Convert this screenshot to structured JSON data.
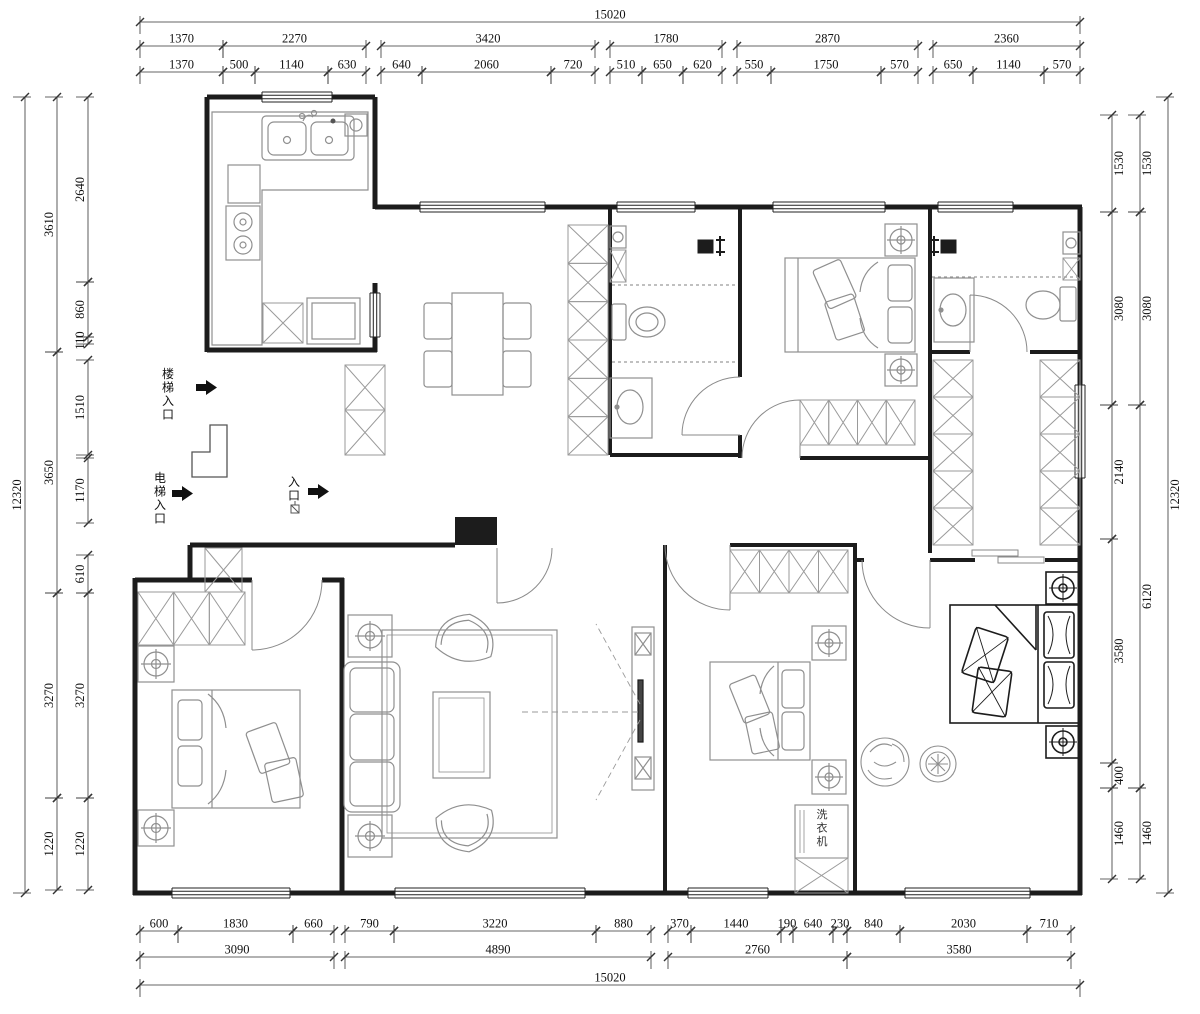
{
  "plan": {
    "unit": "mm",
    "overall_width": "15020",
    "overall_height": "12320"
  },
  "colors": {
    "wall": "#1c1c1c",
    "furniture": "#8f8f8f",
    "dark_furniture": "#1c1c1c",
    "dimension": "#333333",
    "background": "#ffffff"
  },
  "labels": [
    {
      "id": "stair-entrance",
      "text": "楼梯入口",
      "x": 168,
      "y": 366,
      "vertical": true
    },
    {
      "id": "elevator-entrance",
      "text": "电梯入口",
      "x": 160,
      "y": 470,
      "vertical": true
    },
    {
      "id": "entrance",
      "text": "入口",
      "x": 294,
      "y": 474,
      "vertical": true
    },
    {
      "id": "washing-machine",
      "text": "洗衣机",
      "x": 822,
      "y": 806,
      "vertical": true
    }
  ],
  "dimensions": {
    "top": [
      {
        "v": "15020",
        "x1": 140,
        "x2": 1080,
        "y": 22
      },
      {
        "v": "1370",
        "x1": 140,
        "x2": 223,
        "y": 46
      },
      {
        "v": "2270",
        "x1": 223,
        "x2": 366,
        "y": 46
      },
      {
        "v": "3420",
        "x1": 381,
        "x2": 595,
        "y": 46
      },
      {
        "v": "1780",
        "x1": 610,
        "x2": 722,
        "y": 46
      },
      {
        "v": "2870",
        "x1": 737,
        "x2": 918,
        "y": 46
      },
      {
        "v": "2360",
        "x1": 933,
        "x2": 1080,
        "y": 46
      },
      {
        "v": "1370",
        "x1": 140,
        "x2": 223,
        "y": 72
      },
      {
        "v": "500",
        "x1": 223,
        "x2": 255,
        "y": 72
      },
      {
        "v": "1140",
        "x1": 255,
        "x2": 328,
        "y": 72
      },
      {
        "v": "630",
        "x1": 328,
        "x2": 366,
        "y": 72
      },
      {
        "v": "640",
        "x1": 381,
        "x2": 422,
        "y": 72
      },
      {
        "v": "2060",
        "x1": 422,
        "x2": 551,
        "y": 72
      },
      {
        "v": "720",
        "x1": 551,
        "x2": 595,
        "y": 72
      },
      {
        "v": "510",
        "x1": 610,
        "x2": 642,
        "y": 72
      },
      {
        "v": "650",
        "x1": 642,
        "x2": 683,
        "y": 72
      },
      {
        "v": "620",
        "x1": 683,
        "x2": 722,
        "y": 72
      },
      {
        "v": "550",
        "x1": 737,
        "x2": 771,
        "y": 72
      },
      {
        "v": "1750",
        "x1": 771,
        "x2": 881,
        "y": 72
      },
      {
        "v": "570",
        "x1": 881,
        "x2": 918,
        "y": 72
      },
      {
        "v": "650",
        "x1": 933,
        "x2": 973,
        "y": 72
      },
      {
        "v": "1140",
        "x1": 973,
        "x2": 1044,
        "y": 72
      },
      {
        "v": "570",
        "x1": 1044,
        "x2": 1080,
        "y": 72
      }
    ],
    "bottom": [
      {
        "v": "600",
        "x1": 140,
        "x2": 178,
        "y": 931
      },
      {
        "v": "1830",
        "x1": 178,
        "x2": 293,
        "y": 931
      },
      {
        "v": "660",
        "x1": 293,
        "x2": 334,
        "y": 931
      },
      {
        "v": "790",
        "x1": 345,
        "x2": 394,
        "y": 931
      },
      {
        "v": "3220",
        "x1": 394,
        "x2": 596,
        "y": 931
      },
      {
        "v": "880",
        "x1": 596,
        "x2": 651,
        "y": 931
      },
      {
        "v": "370",
        "x1": 668,
        "x2": 691,
        "y": 931
      },
      {
        "v": "1440",
        "x1": 691,
        "x2": 781,
        "y": 931
      },
      {
        "v": "190",
        "x1": 781,
        "x2": 793,
        "y": 931
      },
      {
        "v": "640",
        "x1": 793,
        "x2": 833,
        "y": 931
      },
      {
        "v": "230",
        "x1": 833,
        "x2": 847,
        "y": 931
      },
      {
        "v": "840",
        "x1": 847,
        "x2": 900,
        "y": 931
      },
      {
        "v": "2030",
        "x1": 900,
        "x2": 1027,
        "y": 931
      },
      {
        "v": "710",
        "x1": 1027,
        "x2": 1071,
        "y": 931
      },
      {
        "v": "3090",
        "x1": 140,
        "x2": 334,
        "y": 957
      },
      {
        "v": "4890",
        "x1": 345,
        "x2": 651,
        "y": 957
      },
      {
        "v": "2760",
        "x1": 668,
        "x2": 847,
        "y": 957
      },
      {
        "v": "3580",
        "x1": 847,
        "x2": 1071,
        "y": 957
      },
      {
        "v": "15020",
        "x1": 140,
        "x2": 1080,
        "y": 985
      }
    ],
    "left": [
      {
        "v": "12320",
        "x": 25,
        "y1": 97,
        "y2": 893
      },
      {
        "v": "3610",
        "x": 57,
        "y1": 97,
        "y2": 352
      },
      {
        "v": "3650",
        "x": 57,
        "y1": 352,
        "y2": 593
      },
      {
        "v": "3270",
        "x": 57,
        "y1": 593,
        "y2": 798
      },
      {
        "v": "1220",
        "x": 57,
        "y1": 798,
        "y2": 890
      },
      {
        "v": "2640",
        "x": 88,
        "y1": 97,
        "y2": 282
      },
      {
        "v": "860",
        "x": 88,
        "y1": 282,
        "y2": 337
      },
      {
        "v": "110",
        "x": 88,
        "y1": 337,
        "y2": 344
      },
      {
        "v": "1510",
        "x": 88,
        "y1": 360,
        "y2": 455
      },
      {
        "v": "1170",
        "x": 88,
        "y1": 458,
        "y2": 523
      },
      {
        "v": "610",
        "x": 88,
        "y1": 555,
        "y2": 593
      },
      {
        "v": "3270",
        "x": 88,
        "y1": 593,
        "y2": 798
      },
      {
        "v": "1220",
        "x": 88,
        "y1": 798,
        "y2": 890
      }
    ],
    "right": [
      {
        "v": "1530",
        "x": 1112,
        "y1": 115,
        "y2": 212
      },
      {
        "v": "3080",
        "x": 1112,
        "y1": 212,
        "y2": 405
      },
      {
        "v": "2140",
        "x": 1112,
        "y1": 405,
        "y2": 539
      },
      {
        "v": "3580",
        "x": 1112,
        "y1": 539,
        "y2": 763
      },
      {
        "v": "400",
        "x": 1112,
        "y1": 763,
        "y2": 788
      },
      {
        "v": "1460",
        "x": 1112,
        "y1": 788,
        "y2": 879
      },
      {
        "v": "1530",
        "x": 1140,
        "y1": 115,
        "y2": 212
      },
      {
        "v": "3080",
        "x": 1140,
        "y1": 212,
        "y2": 405
      },
      {
        "v": "6120",
        "x": 1140,
        "y1": 405,
        "y2": 788
      },
      {
        "v": "1460",
        "x": 1140,
        "y1": 788,
        "y2": 879
      },
      {
        "v": "12320",
        "x": 1168,
        "y1": 97,
        "y2": 893
      }
    ]
  }
}
